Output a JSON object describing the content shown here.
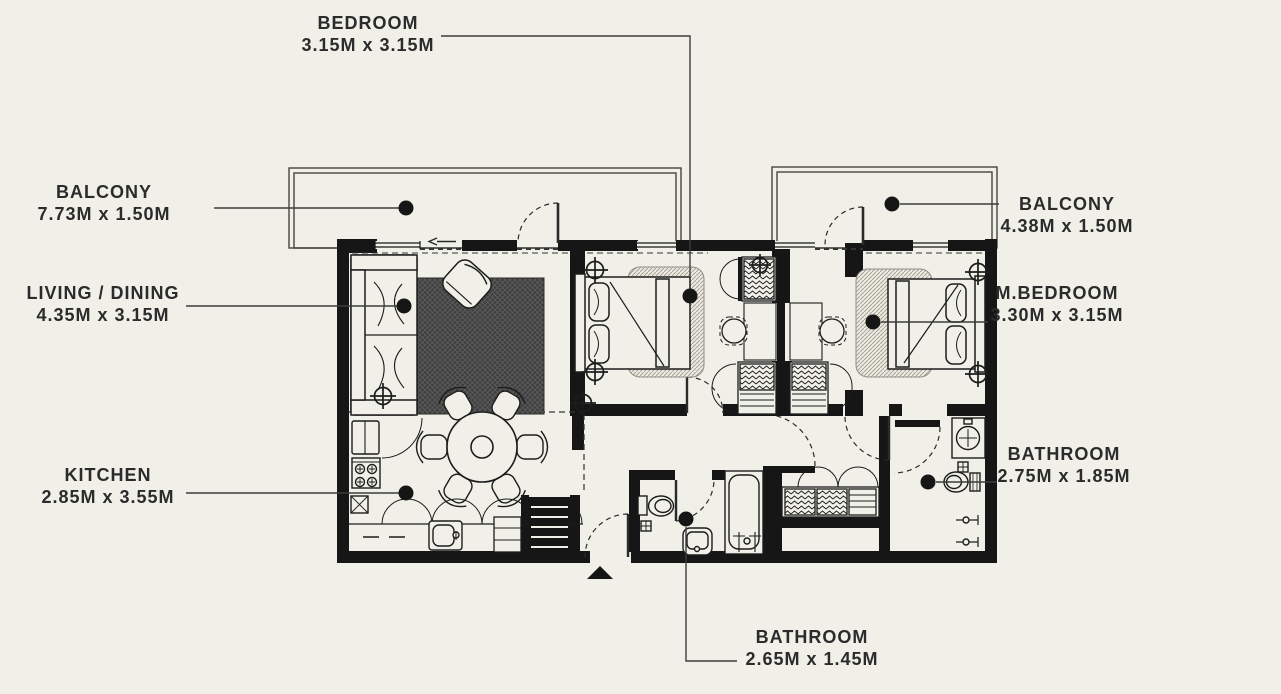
{
  "plan": {
    "colors": {
      "background": "#f1f0e8",
      "walls": "#161616",
      "leader": "#3c3c3c",
      "rug_dark": "#3f3f3f"
    },
    "labels": {
      "bedroom": {
        "title": "BEDROOM",
        "dims": "3.15M x 3.15M"
      },
      "balcony_left": {
        "title": "BALCONY",
        "dims": "7.73M x 1.50M"
      },
      "living_dining": {
        "title": "LIVING / DINING",
        "dims": "4.35M x 3.15M"
      },
      "kitchen": {
        "title": "KITCHEN",
        "dims": "2.85M x 3.55M"
      },
      "balcony_right": {
        "title": "BALCONY",
        "dims": "4.38M x 1.50M"
      },
      "m_bedroom": {
        "title": "M.BEDROOM",
        "dims": "3.30M x 3.15M"
      },
      "bathroom_right": {
        "title": "BATHROOM",
        "dims": "2.75M x 1.85M"
      },
      "bathroom_bottom": {
        "title": "BATHROOM",
        "dims": "2.65M x 1.45M"
      }
    }
  }
}
